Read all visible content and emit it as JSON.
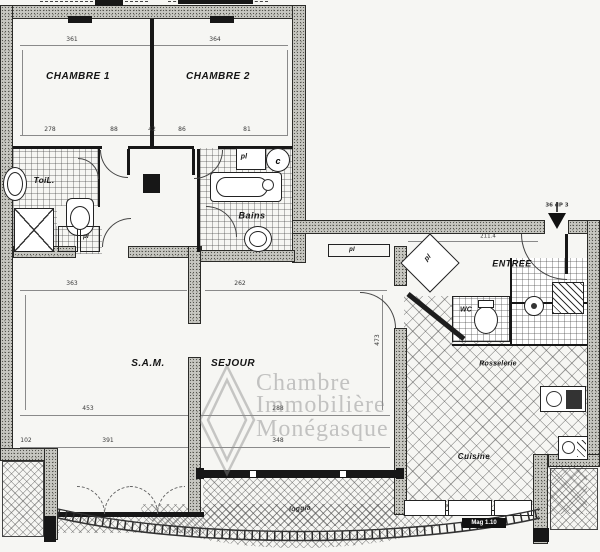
{
  "plan": {
    "rooms": {
      "chambre1": "CHAMBRE 1",
      "chambre2": "CHAMBRE 2",
      "sam": "S.A.M.",
      "sejour": "SEJOUR",
      "entree": "ENTREE",
      "cuisine": "Cuisine",
      "bains": "Bains",
      "toilette": "ToiL.",
      "wc": "WC",
      "loggia": "loggia",
      "annex": "Rosselerie"
    },
    "labels": {
      "closet": "pl",
      "heater": "c"
    },
    "annotations": {
      "entry_door": "36 dP 3",
      "kitchen_window": "Mag 1.10"
    },
    "dimensions": {
      "a": "361",
      "b": "364",
      "c": "278",
      "d": "88",
      "e": "42",
      "f": "86",
      "g": "81",
      "h": "363",
      "i": "262",
      "j": "473",
      "k": "453",
      "l": "288",
      "m": "102",
      "n": "391",
      "o": "348",
      "p": "211.4"
    },
    "watermark": {
      "line1": "Chambre",
      "line2": "Immobilière",
      "line3": "Monégasque"
    }
  },
  "colors": {
    "wall_fill": "#c7c7c1",
    "line": "#1d1d1d",
    "paper": "#f6f6f3",
    "watermark": "#8a8a8a"
  }
}
